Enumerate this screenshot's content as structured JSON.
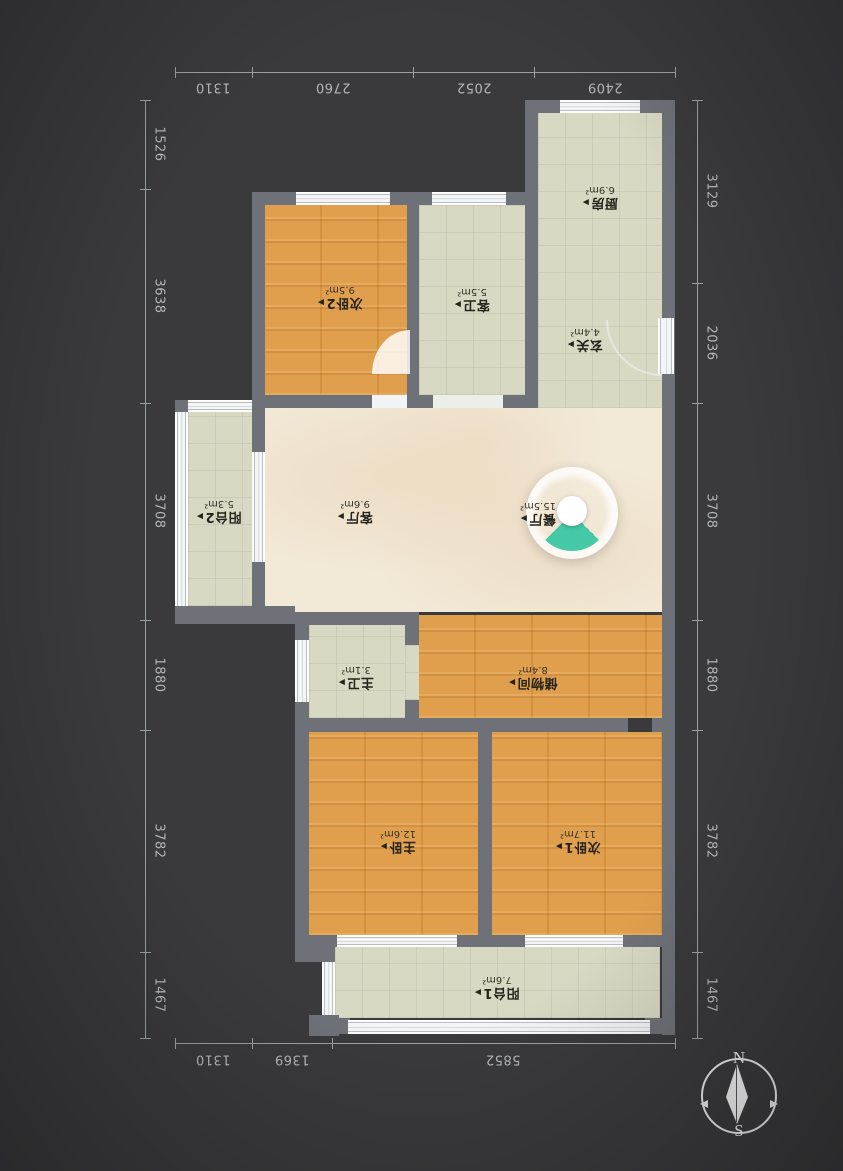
{
  "icons": {
    "room_arrow": "▶",
    "compass_needle": "diamond-needle"
  },
  "compass": {
    "north_label": "N",
    "south_label": "S"
  },
  "dimensions": {
    "top": [
      "1310",
      "2760",
      "2052",
      "2409"
    ],
    "bottom": [
      "1310",
      "1369",
      "5852"
    ],
    "left": [
      "1526",
      "3638",
      "3708",
      "1880",
      "3782",
      "1467"
    ],
    "right": [
      "3129",
      "2036",
      "3708",
      "1880",
      "3782",
      "1467"
    ]
  },
  "rooms": [
    {
      "name": "厨房",
      "area": "6.9m²"
    },
    {
      "name": "次卧2",
      "area": "9.5m²"
    },
    {
      "name": "客卫",
      "area": "5.5m²"
    },
    {
      "name": "玄关",
      "area": "4.4m²"
    },
    {
      "name": "阳台2",
      "area": "5.3m²"
    },
    {
      "name": "客厅",
      "area": "9.6m²"
    },
    {
      "name": "餐厅",
      "area": "15.5m²"
    },
    {
      "name": "主卫",
      "area": "3.1m²"
    },
    {
      "name": "储物间",
      "area": "8.4m²"
    },
    {
      "name": "主卧",
      "area": "12.6m²"
    },
    {
      "name": "次卧1",
      "area": "11.7m²"
    },
    {
      "name": "阳台1",
      "area": "7.6m²"
    }
  ],
  "colors": {
    "background": "#3a3a3c",
    "wall": "#6e7177",
    "tile_floor": "#d8d9c3",
    "wood_floor": "#de9a43",
    "marble_floor": "#f2e9d7",
    "dimension_text": "#b4b7b9",
    "viewpoint_teal": "#3cc7a3",
    "window_white": "#f2f3f5"
  }
}
